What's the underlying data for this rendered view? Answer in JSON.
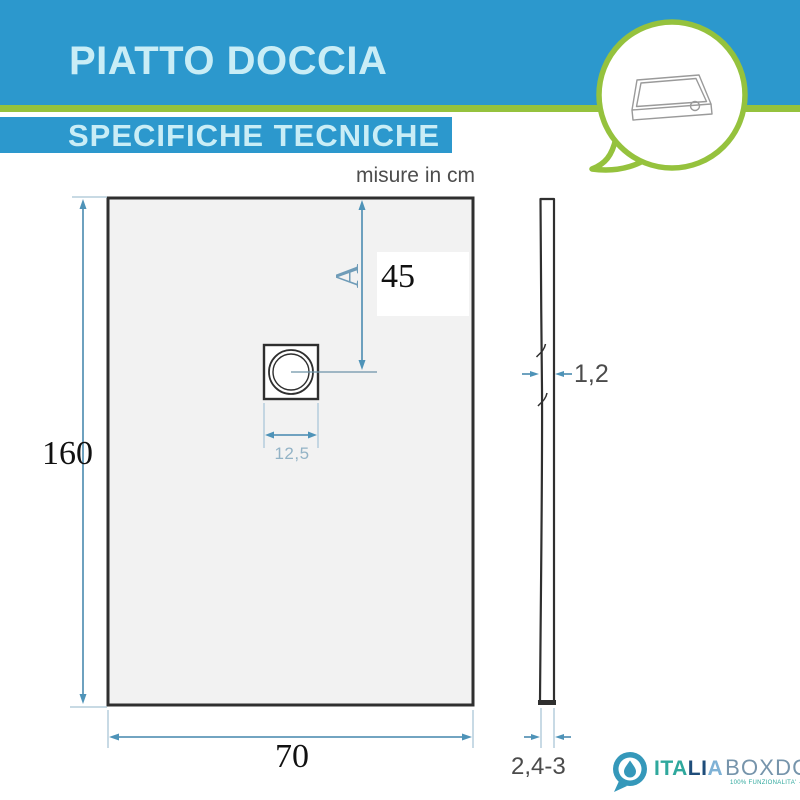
{
  "header": {
    "title": "PIATTO DOCCIA",
    "subtitle": "SPECIFICHE TECNICHE"
  },
  "note": {
    "units": "misure in cm"
  },
  "front_view": {
    "height_cm": "160",
    "width_cm": "70",
    "drain_offset_letter": "A",
    "drain_offset_cm": "45",
    "drain_width_cm": "12,5"
  },
  "side_view": {
    "top_thickness_cm": "1,2",
    "base_thickness_cm": "2,4-3"
  },
  "logo": {
    "name_part1": "ITA",
    "name_part2": "LI",
    "name_part3": "A",
    "name_rest": "BOXDOCCIA",
    "tagline": "100% FUNZIONALITA' · ESTETICA · PRATICITA'"
  },
  "icons": {
    "speech_bubble": "speech-bubble-icon",
    "shower_tray": "shower-tray-3d-icon",
    "logo_bubble": "logo-speech-bubble-icon",
    "water_drop": "water-drop-icon"
  },
  "colors": {
    "banner_blue": "#2c98cd",
    "banner_text": "#c9edf6",
    "accent_green": "#95c23d",
    "dimension_blue": "#5e97b8",
    "extension_blue": "#b5cddc",
    "outline_dark": "#2f2f2f",
    "tray_fill": "#f2f2f2",
    "logo_teal": "#2fa89d",
    "logo_navy": "#1f4d7a",
    "logo_slate": "#7694ab"
  }
}
